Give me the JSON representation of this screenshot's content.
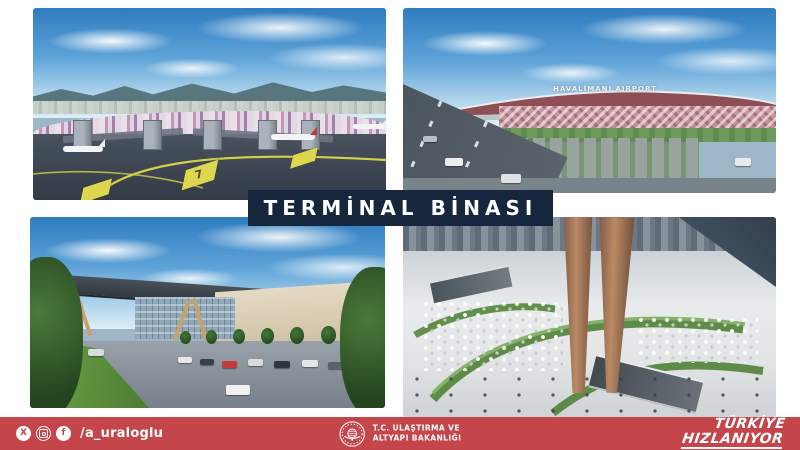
{
  "title_banner": {
    "text": "TERMİNAL BİNASI",
    "bg_color": "#16263c",
    "text_color": "#ffffff"
  },
  "renders": {
    "airside": {
      "apron_marking": "7"
    },
    "approach": {
      "building_sign": "HAVALİMANI AIRPORT"
    }
  },
  "footer": {
    "bg_color": "#c4464b",
    "social": {
      "handle": "/a_uraloglu",
      "icons": [
        "x-icon",
        "instagram-icon",
        "facebook-icon"
      ],
      "x_glyph": "X",
      "facebook_glyph": "f"
    },
    "ministry": {
      "line1": "T.C. ULAŞTIRMA VE",
      "line2": "ALTYAPI BAKANLIĞI"
    },
    "campaign": {
      "line1": "TÜRKİYE",
      "line2": "HIZLANIYOR"
    }
  }
}
